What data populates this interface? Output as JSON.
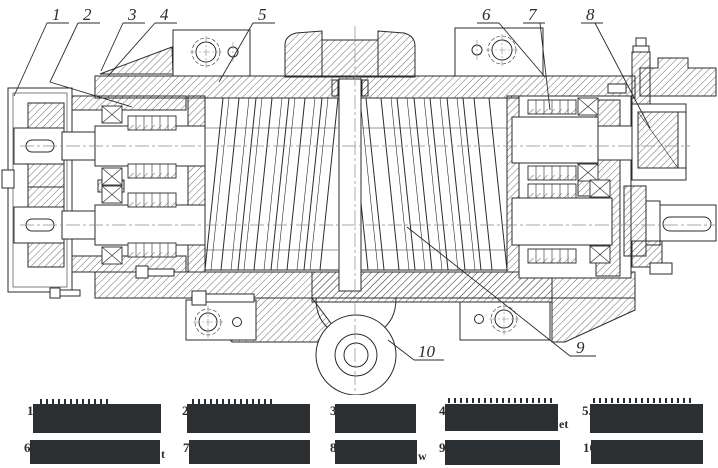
{
  "drawing": {
    "description": "Sectional engineering drawing of a twin screw machine",
    "callouts": [
      "1",
      "2",
      "3",
      "4",
      "5",
      "6",
      "7",
      "8",
      "9",
      "10"
    ]
  },
  "legend": {
    "items": [
      {
        "num": "1.",
        "frag": ""
      },
      {
        "num": "2.",
        "frag": ""
      },
      {
        "num": "3.",
        "frag": ""
      },
      {
        "num": "4.",
        "frag": "et"
      },
      {
        "num": "5.",
        "frag": ""
      },
      {
        "num": "6.",
        "frag": "t"
      },
      {
        "num": "7.",
        "frag": ""
      },
      {
        "num": "8.",
        "frag": "w"
      },
      {
        "num": "9.",
        "frag": ""
      },
      {
        "num": "10.",
        "frag": ""
      }
    ]
  },
  "colors": {
    "line": "#2b2b2b",
    "centerline": "#8a8a8a",
    "redaction_box": "#2c2f31",
    "background": "#ffffff"
  }
}
